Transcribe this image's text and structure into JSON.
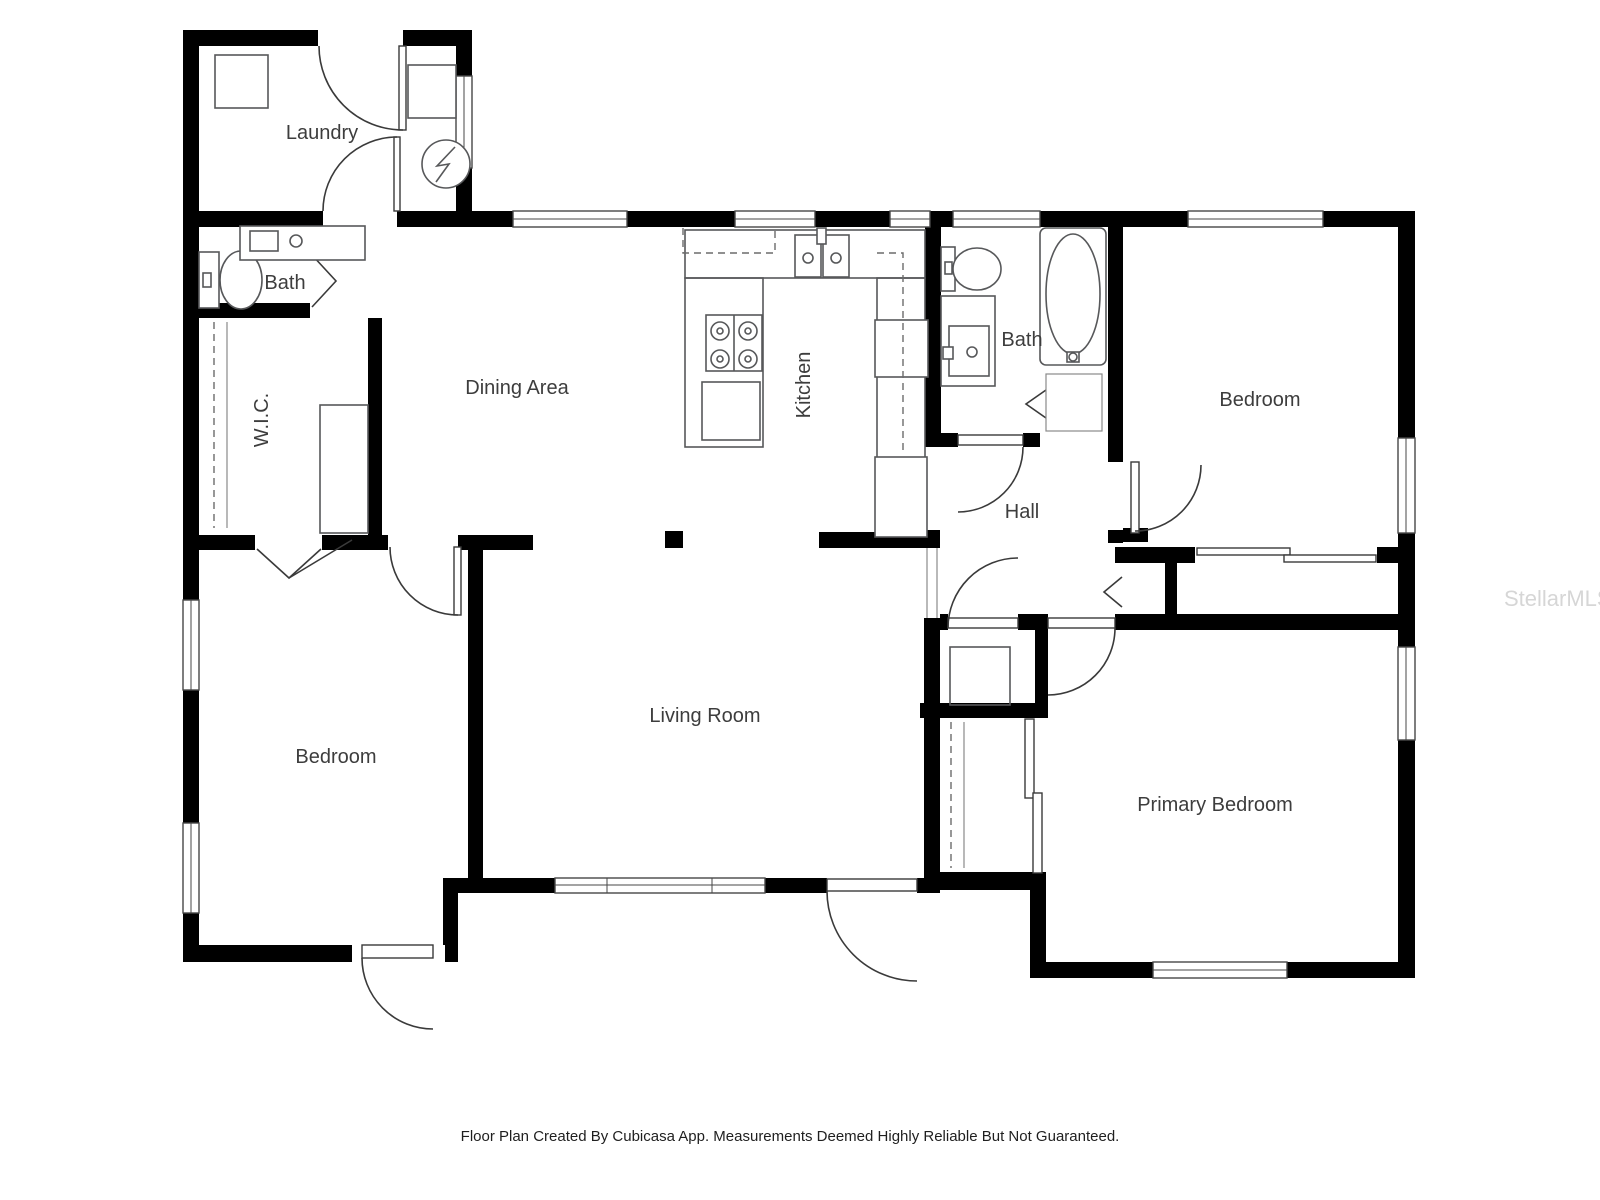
{
  "rooms": {
    "laundry": "Laundry",
    "bath_upper": "Bath",
    "wic": "W.I.C.",
    "dining": "Dining Area",
    "kitchen": "Kitchen",
    "bath_hall": "Bath",
    "bedroom_right": "Bedroom",
    "hall": "Hall",
    "bedroom_left": "Bedroom",
    "living": "Living Room",
    "primary": "Primary Bedroom"
  },
  "footer": {
    "disclaimer": "Floor Plan Created By Cubicasa App. Measurements Deemed Highly Reliable But Not Guaranteed."
  },
  "watermark": {
    "text": "StellarMLS"
  },
  "colors": {
    "wall": "#000000",
    "fixture": "#57585a",
    "text": "#3d3d3d",
    "watermark": "#d6d6d6"
  }
}
